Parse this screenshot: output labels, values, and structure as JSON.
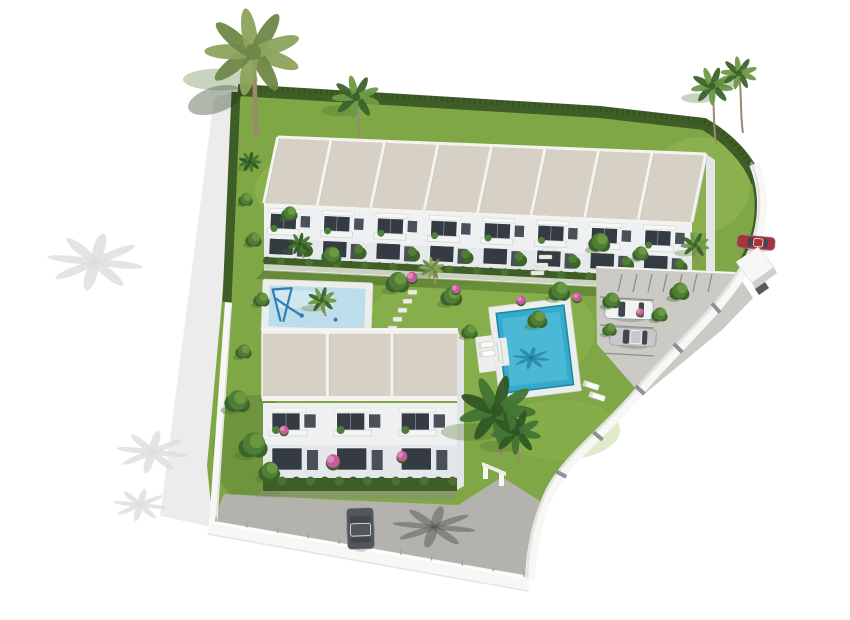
{
  "scene": {
    "kind": "aerial-3d-architectural-render",
    "upper_row_units": 8,
    "lower_block_units": 3,
    "pool_count": 2,
    "vehicle_count": 4
  },
  "colors": {
    "bg": "#ffffff",
    "lawn": "#7fa746",
    "lawnLight": "#95bc56",
    "lawnDark": "#5b8133",
    "hedge": "#3f5d26",
    "hedgeDark": "#324c1e",
    "hedgeLight": "#4e7030",
    "roofBeige": "#d7d1c5",
    "roofEdge": "#f4f3f0",
    "facade": "#eef0f2",
    "facadeShade": "#dbe0e4",
    "windowDark": "#343b43",
    "windowDark2": "#49515a",
    "door": "#4a5057",
    "wallWhite": "#f7f7f5",
    "wallShade": "#d4d4d1",
    "deckWhite": "#eceeeb",
    "kidsPool": "#bcdde9",
    "kidsPoolLight": "#dcedf2",
    "poolBlue": "#35aacc",
    "poolBlueLight": "#62c8de",
    "poolBlueDark": "#1f87a6",
    "paveLight": "#cbcac5",
    "paveLine": "#8f8e89",
    "paveDrive": "#b4b2ad",
    "playBlue": "#2f7fb7",
    "pink": "#c75b9e",
    "pinkLight": "#da8abc",
    "treeDark": "#3c632b",
    "treeMid": "#4f7d35",
    "treeLight": "#6b9a44",
    "oliveDark": "#6f8747",
    "oliveLight": "#8ca35c",
    "lushDark": "#2f5723",
    "lushMid": "#427434",
    "palmTrunk": "#9b8a6e",
    "carWhite": "#f1f2f2",
    "carSilver": "#c6c8ca",
    "carDark": "#53575b",
    "carRed": "#a8333c",
    "glass": "#3f464d",
    "shadowGray": "#dcdddd",
    "shadowGreen": "#4d7029",
    "postGray": "#9aa0a3"
  },
  "upper_row": {
    "units": 8,
    "x_top_left": 278,
    "x_top_right": 706,
    "y_top_left": 137,
    "y_top_right": 154,
    "y_eave_left": 203,
    "y_eave_right": 222,
    "y_face_top_left": 206,
    "y_face_top_right": 225,
    "y_face_bottom_left": 261,
    "y_face_bottom_right": 283,
    "shear": 14
  },
  "lower_row": {
    "units": 3,
    "x": 263,
    "y_roof": 333,
    "w": 194,
    "roof_h": 65,
    "y_facade": 403,
    "facade_h": 87,
    "sep_xs": [
      327.7,
      392.3
    ]
  },
  "parking": {
    "stripes_top": 7,
    "stripe_x0": 622,
    "stripe_step": 15,
    "left_stripe_ys": [
      297,
      325,
      353
    ],
    "pillars": [
      [
        749,
        262,
        -35
      ],
      [
        716,
        308,
        -42
      ],
      [
        678,
        348,
        -45
      ],
      [
        640,
        390,
        -48
      ],
      [
        598,
        436,
        -50
      ],
      [
        561,
        474,
        -62
      ]
    ]
  },
  "vehicles": [
    {
      "name": "white-suv",
      "x": 605,
      "y": 300,
      "w": 48,
      "h": 19,
      "rot": 2,
      "body": "carWhite"
    },
    {
      "name": "silver-sedan",
      "x": 610,
      "y": 328,
      "w": 46,
      "h": 18,
      "rot": 3,
      "body": "carSilver"
    },
    {
      "name": "red-car",
      "x": 737,
      "y": 236,
      "w": 38,
      "h": 13,
      "rot": 5,
      "body": "carRed"
    },
    {
      "name": "gray-car-driveway",
      "x": 347,
      "y": 508,
      "w": 27,
      "h": 41,
      "rot": -2,
      "body": "carDark",
      "vert": true
    }
  ],
  "vegetation": {
    "palms": [
      [
        253,
        52,
        50,
        85,
        "olive"
      ],
      [
        356,
        97,
        25,
        40,
        "green"
      ],
      [
        712,
        86,
        22,
        58,
        "green"
      ],
      [
        739,
        73,
        19,
        60,
        "green"
      ],
      [
        497,
        410,
        40,
        46,
        "lush"
      ],
      [
        516,
        432,
        26,
        30,
        "lush"
      ],
      [
        322,
        300,
        15,
        16,
        "green"
      ],
      [
        300,
        244,
        13,
        14,
        "lush"
      ],
      [
        432,
        268,
        13,
        16,
        "olive"
      ],
      [
        250,
        162,
        12,
        0,
        "lush"
      ],
      [
        695,
        245,
        15,
        18,
        "green"
      ]
    ],
    "trees": [
      [
        332,
        256,
        11
      ],
      [
        398,
        283,
        13
      ],
      [
        452,
        297,
        12
      ],
      [
        560,
        292,
        12
      ],
      [
        612,
        301,
        10
      ],
      [
        600,
        243,
        12
      ],
      [
        641,
        254,
        9
      ],
      [
        680,
        292,
        11
      ],
      [
        238,
        402,
        14
      ],
      [
        254,
        446,
        16
      ],
      [
        270,
        472,
        12
      ],
      [
        538,
        320,
        11
      ],
      [
        470,
        332,
        9
      ],
      [
        290,
        214,
        9
      ],
      [
        262,
        300,
        9
      ],
      [
        244,
        352,
        9
      ],
      [
        246,
        200,
        8
      ],
      [
        254,
        240,
        9
      ],
      [
        610,
        330,
        8
      ],
      [
        660,
        315,
        9
      ]
    ],
    "pink_shrubs": [
      [
        412,
        277,
        7
      ],
      [
        456,
        289,
        6
      ],
      [
        521,
        300,
        6
      ],
      [
        577,
        297,
        6
      ],
      [
        640,
        312,
        5
      ],
      [
        333,
        461,
        9
      ],
      [
        402,
        456,
        7
      ],
      [
        284,
        430,
        6
      ]
    ],
    "gray_palm_shadows": [
      [
        95,
        262,
        46
      ],
      [
        152,
        452,
        34
      ],
      [
        140,
        505,
        26
      ]
    ],
    "driveway_palm_shadow": [
      434,
      527,
      40
    ],
    "pool_palm_shadow": [
      531,
      358,
      18
    ]
  },
  "walls": {
    "bottom_posts": 11
  },
  "paths": {
    "stones_a": {
      "x": 408,
      "y": 290,
      "n": 5,
      "dx": -5,
      "dy": 9,
      "w": 9,
      "h": 4.5
    },
    "stairs_b": {
      "x": 543,
      "y": 247,
      "n": 4,
      "dx": -4,
      "dy": 8,
      "w": 13,
      "h": 4
    }
  },
  "loungers": [
    {
      "x": 479,
      "y": 336,
      "rot": -7,
      "cx": 535,
      "cy": 350
    },
    {
      "x": 479,
      "y": 345,
      "rot": -7,
      "cx": 535,
      "cy": 350
    },
    {
      "x": 583,
      "y": 383,
      "rot": 18,
      "cx": 592,
      "cy": 386
    },
    {
      "x": 589,
      "y": 394,
      "rot": 18,
      "cx": 598,
      "cy": 397
    }
  ]
}
